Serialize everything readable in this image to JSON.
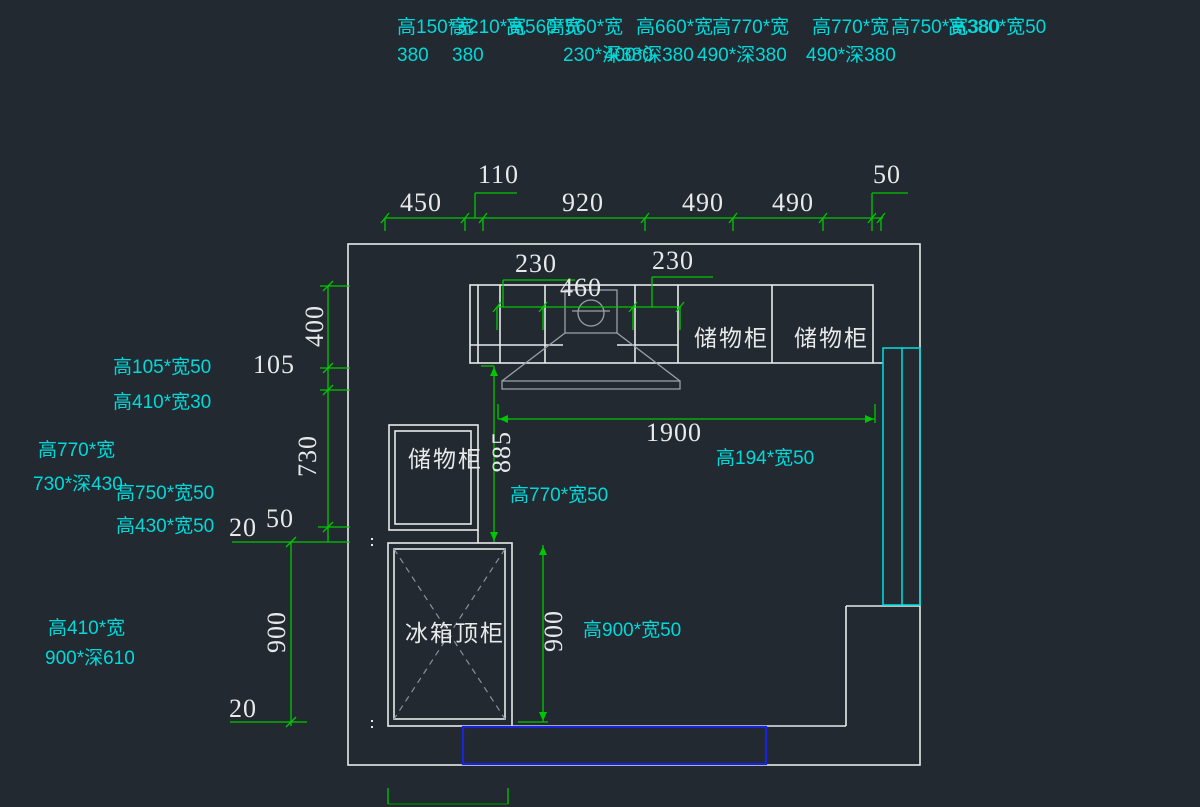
{
  "colors": {
    "background": "#222931",
    "line_white": "#e8eaea",
    "dim_green": "#00c800",
    "dim_green_dark": "#007d00",
    "label_cyan": "#00d9d9",
    "hood_gray": "#9aa1a8",
    "dash_gray": "#8a9098",
    "highlight_blue": "#1824d8",
    "panel_cyan": "#00d7d7"
  },
  "labels": [
    {
      "n": "spec-text-1",
      "t": "高150*宽",
      "k": "spec",
      "x": 397,
      "y": 18
    },
    {
      "n": "spec-text-2",
      "t": "高210*宽",
      "k": "spec",
      "x": 449,
      "y": 18
    },
    {
      "n": "spec-text-3",
      "t": "高560*宽",
      "k": "spec",
      "x": 506,
      "y": 18
    },
    {
      "n": "spec-text-4",
      "t": "高560*宽",
      "k": "spec",
      "x": 546,
      "y": 18
    },
    {
      "n": "spec-text-5",
      "t": "高660*宽",
      "k": "spec",
      "x": 636,
      "y": 18
    },
    {
      "n": "spec-text-6",
      "t": "高770*宽",
      "k": "spec",
      "x": 712,
      "y": 18
    },
    {
      "n": "spec-text-7",
      "t": "高770*宽",
      "k": "spec",
      "x": 812,
      "y": 18
    },
    {
      "n": "spec-text-8",
      "t": "高750*宽380",
      "k": "spec",
      "x": 891,
      "y": 18
    },
    {
      "n": "spec-text-9",
      "t": "高380*宽50",
      "k": "spec",
      "x": 948,
      "y": 18
    },
    {
      "n": "spec-text-10",
      "t": "380",
      "k": "spec",
      "x": 397,
      "y": 46
    },
    {
      "n": "spec-text-11",
      "t": "380",
      "k": "spec",
      "x": 452,
      "y": 46
    },
    {
      "n": "spec-text-12",
      "t": "230*深380",
      "k": "spec",
      "x": 563,
      "y": 46
    },
    {
      "n": "spec-text-13",
      "t": "400*深380",
      "k": "spec",
      "x": 604,
      "y": 46
    },
    {
      "n": "spec-text-14",
      "t": "490*深380",
      "k": "spec",
      "x": 697,
      "y": 46
    },
    {
      "n": "spec-text-15",
      "t": "490*深380",
      "k": "spec",
      "x": 806,
      "y": 46
    },
    {
      "n": "spec-text-16",
      "t": "高105*宽50",
      "k": "spec",
      "x": 113,
      "y": 358
    },
    {
      "n": "spec-text-17",
      "t": "高410*宽30",
      "k": "spec",
      "x": 113,
      "y": 393
    },
    {
      "n": "spec-text-18",
      "t": "高770*宽",
      "k": "spec",
      "x": 38,
      "y": 441
    },
    {
      "n": "spec-text-19",
      "t": "730*深430",
      "k": "spec",
      "x": 33,
      "y": 475
    },
    {
      "n": "spec-text-20",
      "t": "高750*宽50",
      "k": "spec",
      "x": 116,
      "y": 484
    },
    {
      "n": "spec-text-21",
      "t": "高430*宽50",
      "k": "spec",
      "x": 116,
      "y": 517
    },
    {
      "n": "spec-text-22",
      "t": "高410*宽",
      "k": "spec",
      "x": 48,
      "y": 619
    },
    {
      "n": "spec-text-23",
      "t": "900*深610",
      "k": "spec",
      "x": 45,
      "y": 649
    },
    {
      "n": "spec-text-24",
      "t": "高770*宽50",
      "k": "spec",
      "x": 510,
      "y": 486
    },
    {
      "n": "spec-text-25",
      "t": "高194*宽50",
      "k": "spec",
      "x": 716,
      "y": 449
    },
    {
      "n": "spec-text-26",
      "t": "高900*宽50",
      "k": "spec",
      "x": 583,
      "y": 621
    },
    {
      "n": "dim-450",
      "t": "450",
      "k": "dim",
      "x": 400,
      "y": 190
    },
    {
      "n": "dim-110",
      "t": "110",
      "k": "dim",
      "x": 478,
      "y": 162
    },
    {
      "n": "dim-920",
      "t": "920",
      "k": "dim",
      "x": 562,
      "y": 190
    },
    {
      "n": "dim-490-a",
      "t": "490",
      "k": "dim",
      "x": 682,
      "y": 190
    },
    {
      "n": "dim-490-b",
      "t": "490",
      "k": "dim",
      "x": 772,
      "y": 190
    },
    {
      "n": "dim-50-top",
      "t": "50",
      "k": "dim",
      "x": 873,
      "y": 162
    },
    {
      "n": "dim-230-left",
      "t": "230",
      "k": "dim",
      "x": 515,
      "y": 251
    },
    {
      "n": "dim-460",
      "t": "460",
      "k": "dim",
      "x": 560,
      "y": 275
    },
    {
      "n": "dim-230-right",
      "t": "230",
      "k": "dim",
      "x": 652,
      "y": 248
    },
    {
      "n": "dim-105",
      "t": "105",
      "k": "dim",
      "x": 253,
      "y": 352
    },
    {
      "n": "dim-400",
      "t": "400",
      "k": "dim",
      "x": 315,
      "y": 326,
      "rot": 1
    },
    {
      "n": "dim-730",
      "t": "730",
      "k": "dim",
      "x": 308,
      "y": 456,
      "rot": 1
    },
    {
      "n": "dim-20-upper",
      "t": "20",
      "k": "dim",
      "x": 229,
      "y": 515
    },
    {
      "n": "dim-50-left",
      "t": "50",
      "k": "dim",
      "x": 266,
      "y": 506
    },
    {
      "n": "dim-900-left",
      "t": "900",
      "k": "dim",
      "x": 277,
      "y": 632,
      "rot": 1
    },
    {
      "n": "dim-20-lower",
      "t": "20",
      "k": "dim",
      "x": 229,
      "y": 696
    },
    {
      "n": "dim-885",
      "t": "885",
      "k": "dim",
      "x": 502,
      "y": 452,
      "rot": 1
    },
    {
      "n": "dim-1900",
      "t": "1900",
      "k": "dim",
      "x": 646,
      "y": 420
    },
    {
      "n": "dim-900-right",
      "t": "900",
      "k": "dim",
      "x": 554,
      "y": 631,
      "rot": 1
    },
    {
      "n": "cabinet-label-storage-1",
      "t": "储物柜",
      "k": "cab",
      "x": 694,
      "y": 327
    },
    {
      "n": "cabinet-label-storage-2",
      "t": "储物柜",
      "k": "cab",
      "x": 794,
      "y": 327
    },
    {
      "n": "cabinet-label-storage-3",
      "t": "储物柜",
      "k": "cab",
      "x": 408,
      "y": 448
    },
    {
      "n": "cabinet-label-fridge-top",
      "t": "冰箱顶柜",
      "k": "cab",
      "x": 405,
      "y": 622
    }
  ]
}
